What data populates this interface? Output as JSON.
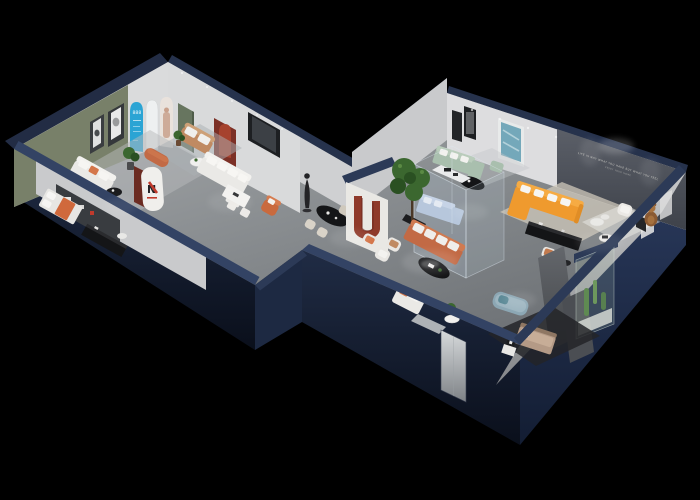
{
  "scene": {
    "description": "Isometric 3D cutaway render of a furniture showroom floor plan on a black background",
    "background": "#000000"
  },
  "colors": {
    "bg": "#000000",
    "wall_cap": "#2c3a57",
    "wall_cap_light": "#334364",
    "wall_face_dark": "#10192a",
    "wall_face": "#1b2539",
    "wall_face_light": "#263450",
    "wall_inner_white": "#d8d9da",
    "olive_wall": "#788069",
    "feature_wall": "#4b4f56",
    "floor_main": "#8f9396",
    "rug_light": "#b7b9bb",
    "rug_beige": "#cfc8bb",
    "glass_blue": "#bcd4e6",
    "arch_blue": "#2ba4d4",
    "door_green": "#67755f",
    "arch_red": "#7c3026",
    "arch_red_light": "#a6422e",
    "dark_red": "#6b2b21",
    "sofa_white": "#eae9e6",
    "sofa_white_hi": "#f3f2ef",
    "cushion_orange": "#d4764a",
    "orange": "#ef9a2e",
    "orange_hi": "#f6ab43",
    "terracotta": "#c26a45",
    "terracotta_hi": "#d07a50",
    "sage": "#a9bfae",
    "sage_hi": "#b9ccbb",
    "teal_art": "#74a8ba",
    "tan": "#c08a62",
    "tan_hi": "#cda077",
    "wood_brown": "#8a5a33",
    "wood_brown_hi": "#a5713f",
    "plant_green": "#3b672f",
    "plant_dark": "#2a5022",
    "plant_light": "#5b8a44",
    "black_item": "#141517",
    "black_item_hi": "#2a2b2e",
    "statue": "#232326",
    "blue_gray": "#8ca7b4",
    "blue_gray_hi": "#9db5c0",
    "bed_tan": "#b49a86",
    "bed_tan_hi": "#c7ad97",
    "logo_red": "#c03a2c"
  },
  "texts": {
    "feature_wall_slogan_line1": "LIFE IS NOT WHAT YOU HAVE BUT WHAT YOU FEEL",
    "feature_wall_slogan_line2": "ENJOY YOUR HOME",
    "blue_arch_text": "888",
    "brand_pillar_logo": "N"
  },
  "rooms": [
    {
      "name": "green-accent-lounge",
      "furniture": [
        "white sofa with orange cushion",
        "two wall art frames",
        "floor plant",
        "black bistro table and chair",
        "area rug"
      ]
    },
    {
      "name": "arch-display-wall",
      "furniture": [
        "blue arch panel",
        "white arch niche",
        "model photo arch",
        "green door",
        "red arch niche"
      ]
    },
    {
      "name": "small-lounge",
      "furniture": [
        "tan loveseat",
        "terracotta ottoman",
        "round coffee table",
        "side plant",
        "blue-gray rug"
      ]
    },
    {
      "name": "bedroom-left",
      "furniture": [
        "bed with orange throw",
        "dark media wall with shelf",
        "black media console",
        "small white table"
      ]
    },
    {
      "name": "central-corridor",
      "furniture": [
        "white corner sofa",
        "white dining table",
        "black oval dining table",
        "cream chairs",
        "figure statue",
        "brand pillar sign",
        "red U arch display",
        "orange armchair"
      ]
    },
    {
      "name": "glass-display-cube",
      "furniture": [
        "light blue sectional",
        "white island counter"
      ]
    },
    {
      "name": "main-showroom",
      "furniture": [
        "coral sectional sofa",
        "black oval coffee table",
        "white armchairs",
        "white loveseat",
        "potted tree",
        "plant side table"
      ]
    },
    {
      "name": "sage-lounge",
      "furniture": [
        "sage green corner sofa",
        "sage ottoman",
        "black oval table",
        "teal abstract artwork",
        "black frame art pair"
      ]
    },
    {
      "name": "feature-wall-lounge",
      "furniture": [
        "orange L-shaped sofa with white pillows",
        "black media console",
        "round side tables",
        "white armchair",
        "teddy bear figure",
        "beige rug"
      ]
    },
    {
      "name": "bedroom-right",
      "furniture": [
        "blue-gray daybed",
        "tan bed on dark floor",
        "white side table with art print",
        "gray partitions",
        "glass cactus display",
        "accent chair with copper cushion"
      ]
    },
    {
      "name": "entrance",
      "furniture": [
        "light door panel in navy wall"
      ]
    }
  ]
}
